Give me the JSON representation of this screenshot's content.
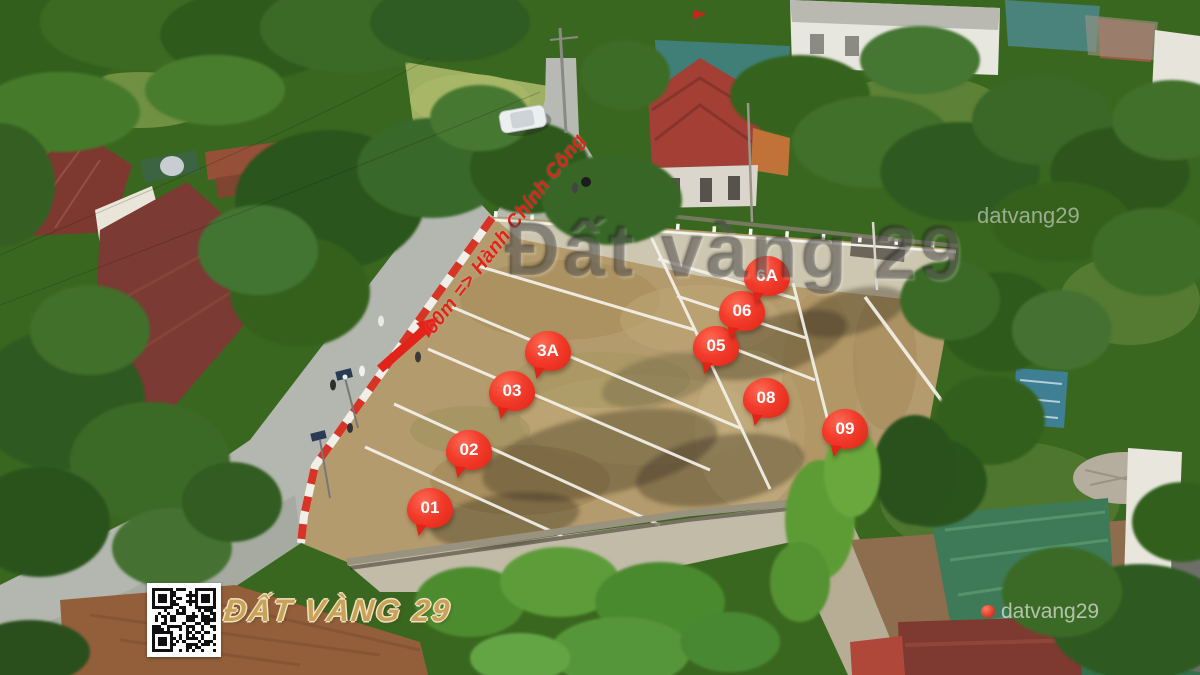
{
  "scene": {
    "type": "aerial-drone-photo",
    "subject": "residential land subdivision with numbered plots for sale"
  },
  "plots": [
    {
      "label": "01",
      "x": 430,
      "y": 508
    },
    {
      "label": "02",
      "x": 469,
      "y": 450
    },
    {
      "label": "03",
      "x": 512,
      "y": 391
    },
    {
      "label": "3A",
      "x": 548,
      "y": 351
    },
    {
      "label": "05",
      "x": 716,
      "y": 346
    },
    {
      "label": "06",
      "x": 742,
      "y": 311
    },
    {
      "label": "6A",
      "x": 767,
      "y": 276
    },
    {
      "label": "08",
      "x": 766,
      "y": 398
    },
    {
      "label": "09",
      "x": 845,
      "y": 429
    }
  ],
  "annotations": {
    "direction_note": "60m => Hành Chính Công"
  },
  "watermarks": {
    "center": "Đất vàng 29",
    "top_right": "datvang29",
    "bottom_right": "datvang29",
    "brand": "ĐẤT VÀNG 29"
  },
  "colors": {
    "badge_red": "#ef3425",
    "annotation_red": "#e2231a",
    "brand_gold": "#c9a257",
    "field_tan": "#b49b6d",
    "road_gray": "#b6bab2"
  }
}
